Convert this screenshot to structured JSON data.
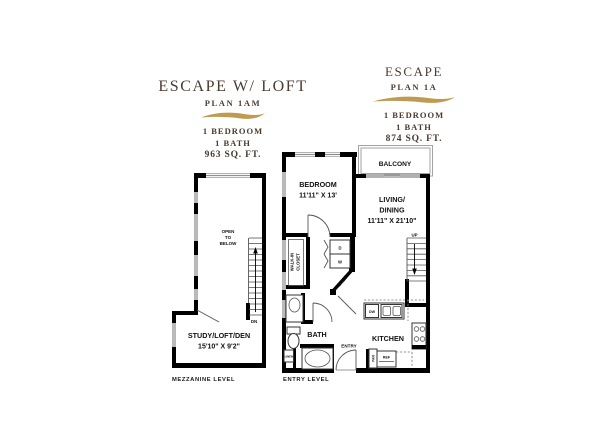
{
  "colors": {
    "title_text": "#4a3b2f",
    "accent_gold": "#bf9b51",
    "wall": "#000000"
  },
  "left_plan": {
    "title": "ESCAPE W/ LOFT",
    "plan": "PLAN 1AM",
    "bedroom": "1 BEDROOM",
    "bath": "1 BATH",
    "sqft": "963 SQ. FT.",
    "level_caption": "MEZZANINE LEVEL",
    "rooms": {
      "open1": "OPEN",
      "open2": "TO",
      "open3": "BELOW",
      "study": "STUDY/LOFT/DEN",
      "study_dim": "15'10\" X 9'2\"",
      "dn": "DN"
    }
  },
  "right_plan": {
    "title": "ESCAPE",
    "plan": "PLAN 1A",
    "bedroom": "1 BEDROOM",
    "bath": "1 BATH",
    "sqft": "874 SQ. FT.",
    "level_caption": "ENTRY LEVEL",
    "rooms": {
      "bedroom": "BEDROOM",
      "bedroom_dim": "11'11\" X 13'",
      "balcony": "BALCONY",
      "living1": "LIVING/",
      "living2": "DINING",
      "living_dim": "11'11\" X 21'10\"",
      "walkin1": "WALK-IN",
      "walkin2": "CLOSET",
      "bath": "BATH",
      "kitchen": "KITCHEN",
      "entry": "ENTRY",
      "linen_diag": "LINEN",
      "linen_small": "LINEN",
      "up": "UP",
      "washer": "W",
      "dryer": "D",
      "dishwasher": "DW",
      "refrigerator": "REF",
      "pantry": "PAN"
    }
  }
}
